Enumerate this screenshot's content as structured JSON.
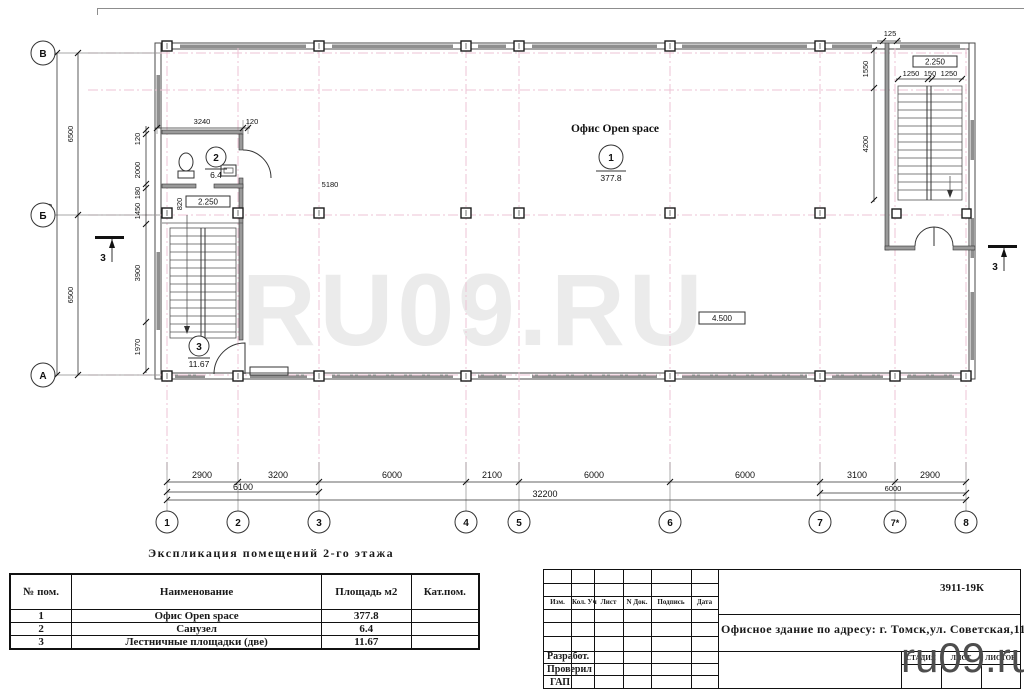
{
  "watermark": {
    "center": "RU09.RU",
    "corner": "ru09.ru"
  },
  "plan": {
    "rooms": [
      {
        "name": "Офис Open space",
        "number": "1",
        "area": "377.8"
      },
      {
        "name": "Санузел",
        "number": "2",
        "area": "6.4"
      },
      {
        "name": "Лестничные площадки",
        "number": "3",
        "area": "11.67"
      }
    ],
    "elevations": {
      "wc": "2.250",
      "stair": "2.250",
      "hall": "4.500"
    },
    "ceiling_height": "5180",
    "grid_rows": [
      "В",
      "Б",
      "А"
    ],
    "grid_cols": [
      "1",
      "2",
      "3",
      "4",
      "5",
      "6",
      "7",
      "7*",
      "8"
    ],
    "dims": {
      "left_total": "13800",
      "left_spans": [
        "6500",
        "6500"
      ],
      "left_chain": [
        "120",
        "2000",
        "180",
        "1450",
        "3900",
        "1970"
      ],
      "wc_width": "3240",
      "wc_wall": "120",
      "wc_door": "820",
      "stair2_offset": "125",
      "stair2_widths": [
        "1250",
        "150",
        "1250"
      ],
      "stair2_heights": [
        "1550",
        "4200"
      ],
      "bays": [
        "2900",
        "3200",
        "6000",
        "2100",
        "6000",
        "6000",
        "3100",
        "2900"
      ],
      "sub": [
        "6100",
        "6000"
      ],
      "total": "32200"
    },
    "section_label": "3"
  },
  "schedule": {
    "title": "Экспликация помещений 2-го этажа",
    "headers": [
      "№ пом.",
      "Наименование",
      "Площадь м2",
      "Кат.пом."
    ],
    "rows": [
      [
        "1",
        "Офис Open space",
        "377.8",
        ""
      ],
      [
        "2",
        "Санузел",
        "6.4",
        ""
      ],
      [
        "3",
        "Лестничные площадки (две)",
        "11.67",
        ""
      ]
    ]
  },
  "titleblock": {
    "doc_number": "3911-19К",
    "columns": [
      "Изм.",
      "Кол. Уч",
      "Лист",
      "N Док.",
      "Подпись",
      "Дата"
    ],
    "project": "Офисное здание по адресу: г. Томск,ул. Советская,115",
    "stage_cols": [
      "СТАДИЯ",
      "ЛИСТ",
      "ЛИСТОВ"
    ],
    "roles": [
      "Разработ.",
      "Проверил",
      "ГАП"
    ]
  }
}
